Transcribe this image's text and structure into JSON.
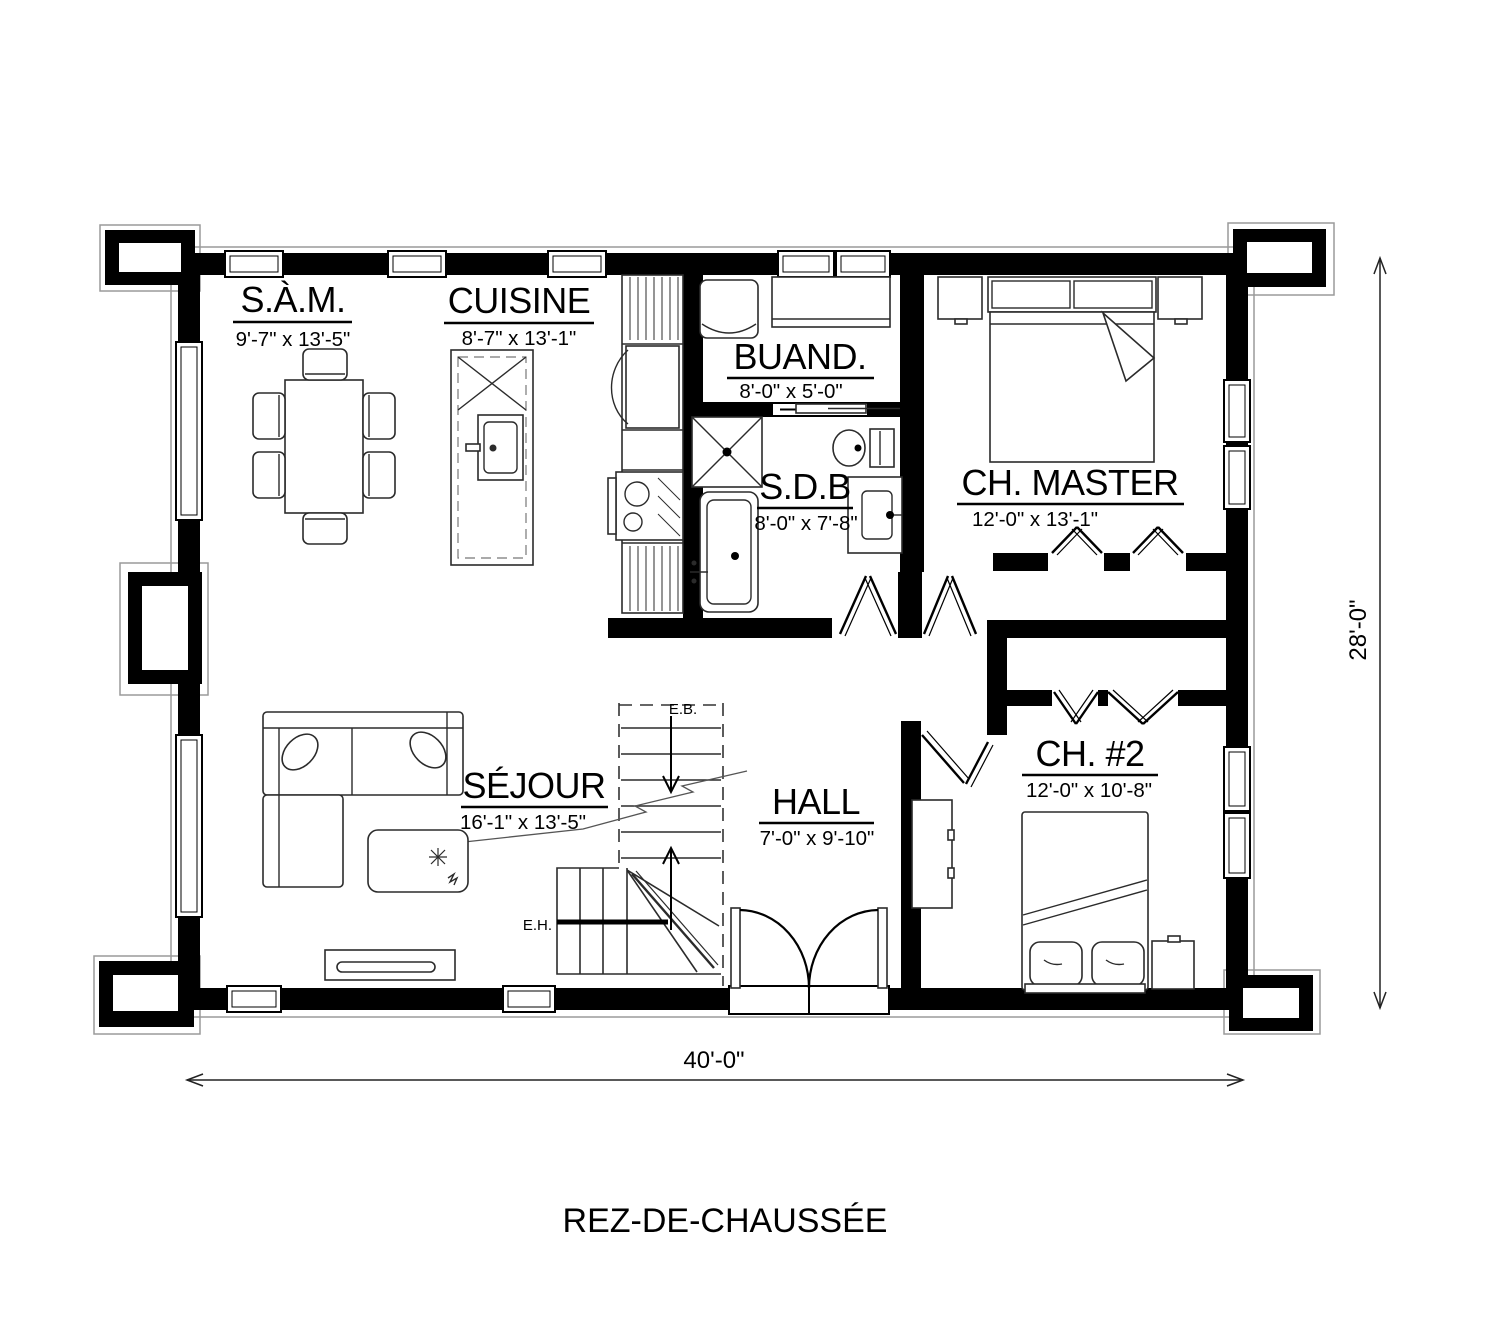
{
  "title": "REZ-DE-CHAUSSÉE",
  "rooms": [
    {
      "id": "sam",
      "name": "S.À.M.",
      "dims": "9'-7\" x 13'-5\""
    },
    {
      "id": "cuisine",
      "name": "CUISINE",
      "dims": "8'-7\" x 13'-1\""
    },
    {
      "id": "buand",
      "name": "BUAND.",
      "dims": "8'-0\" x 5'-0\""
    },
    {
      "id": "sdb",
      "name": "S.D.B",
      "dims": "8'-0\" x 7'-8\""
    },
    {
      "id": "master",
      "name": "CH. MASTER",
      "dims": "12'-0\" x 13'-1\""
    },
    {
      "id": "sejour",
      "name": "SÉJOUR",
      "dims": "16'-1\" x 13'-5\""
    },
    {
      "id": "hall",
      "name": "HALL",
      "dims": "7'-0\" x 9'-10\""
    },
    {
      "id": "ch2",
      "name": "CH. #2",
      "dims": "12'-0\" x 10'-8\""
    }
  ],
  "stairs": {
    "down_label": "E.B.",
    "up_label": "E.H."
  },
  "overall_dimensions": {
    "width": "40'-0\"",
    "depth": "28'-0\""
  },
  "colors": {
    "wall": "#000000",
    "drawing_line": "#2b2b2b",
    "foundation_line": "#9a9a9a",
    "background": "#ffffff"
  }
}
